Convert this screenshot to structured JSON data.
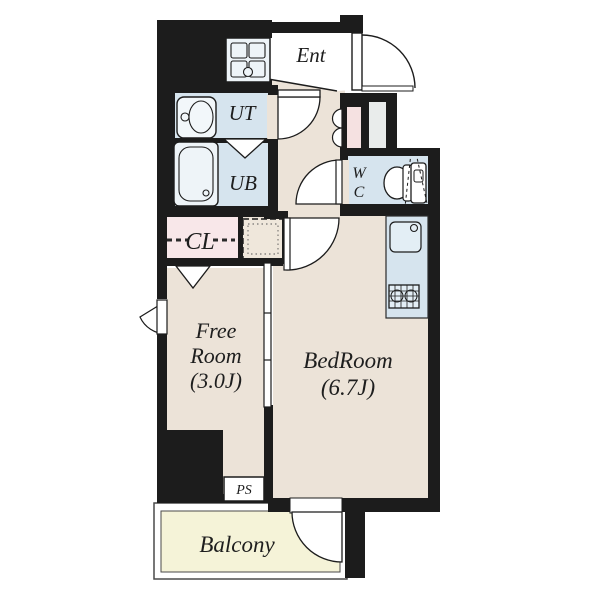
{
  "document_type": "apartment-floor-plan",
  "rooms": [
    {
      "id": "ent",
      "label": "Ent"
    },
    {
      "id": "ut",
      "label": "UT"
    },
    {
      "id": "ub",
      "label": "UB"
    },
    {
      "id": "wc",
      "label_lines": [
        "W",
        "C"
      ]
    },
    {
      "id": "cl",
      "label": "CL"
    },
    {
      "id": "free-room",
      "label_lines": [
        "Free",
        "Room",
        "(3.0J)"
      ],
      "area": "3.0J"
    },
    {
      "id": "bedroom",
      "label_lines": [
        "BedRoom",
        "(6.7J)"
      ],
      "area": "6.7J"
    },
    {
      "id": "ps",
      "label": "PS"
    },
    {
      "id": "balcony",
      "label": "Balcony"
    }
  ],
  "labels": {
    "ent": "Ent",
    "ut": "UT",
    "ub": "UB",
    "wc_w": "W",
    "wc_c": "C",
    "cl": "CL",
    "free1": "Free",
    "free2": "Room",
    "free3": "(3.0J)",
    "bed1": "BedRoom",
    "bed2": "(6.7J)",
    "ps": "PS",
    "balcony": "Balcony"
  },
  "icons": [
    "entrance-door-icon",
    "kitchen-stove-icon",
    "washbasin-icon",
    "bathtub-icon",
    "folding-door-icon",
    "toilet-icon",
    "kitchen-sink-icon",
    "gas-range-icon",
    "sliding-partition-icon",
    "window-icon",
    "balcony-door-icon",
    "bifold-storage-door-icon",
    "closet-hanger-icon"
  ],
  "colors": {
    "wall": "#1c1c1c",
    "floor_wood": "#ece3d8",
    "wet_area_blue": "#d6e4ee",
    "closet_pink": "#f8e7e9",
    "utility_pink": "#f5e1e1",
    "utility_gray": "#e9eceb",
    "balcony_yellow": "#f5f3d8",
    "fixture_white": "#f2f7fa",
    "background": "#ffffff"
  }
}
